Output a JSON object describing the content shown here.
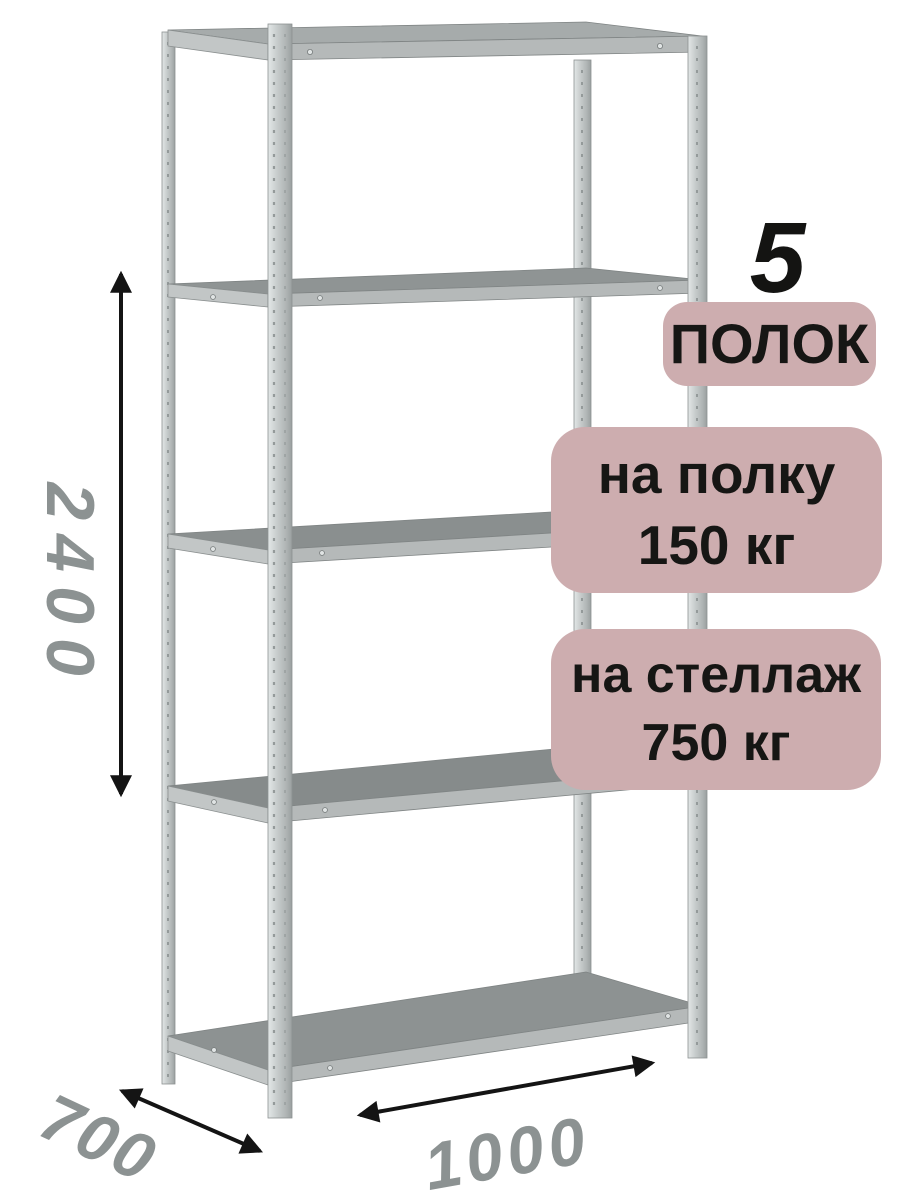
{
  "illustration": {
    "object": "metal-shelving-rack-render",
    "shelf_count_visual": 5,
    "post_count_visual": 4
  },
  "annotation": {
    "shelf_count": "5",
    "shelf_count_label": "ПОЛОК",
    "shelf_capacity": {
      "line1": "на полку",
      "line2": "150 кг"
    },
    "rack_capacity": {
      "line1": "на стеллаж",
      "line2": "750 кг"
    }
  },
  "dimensions": {
    "height": "2400",
    "depth": "700",
    "width": "1000"
  },
  "colors": {
    "background": "#ffffff",
    "badge_bg": "#cdadaf",
    "badge_text": "#161614",
    "dimension_text": "#8c9292",
    "arrow": "#141414",
    "metal_light": "#c6cbcb",
    "metal_face": "#b5b9b9",
    "metal_top": "#8d9292"
  }
}
